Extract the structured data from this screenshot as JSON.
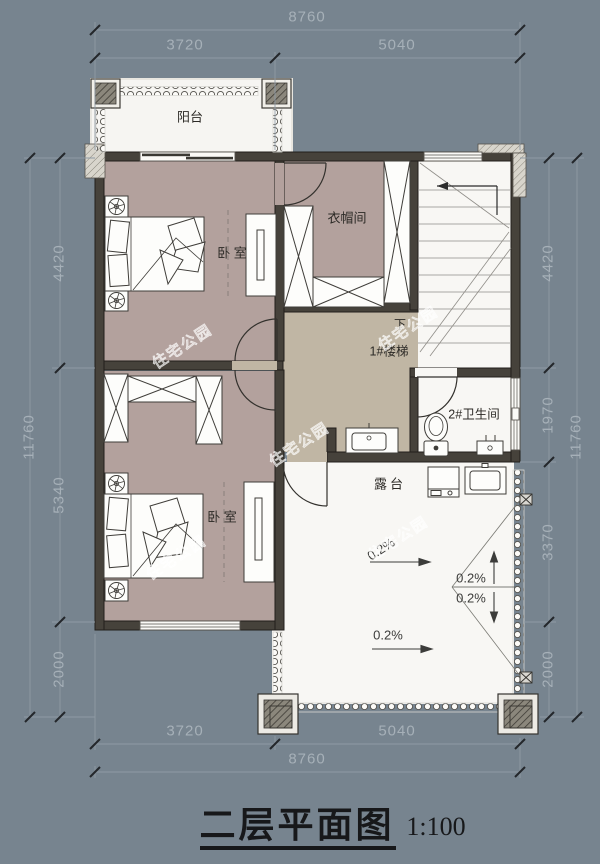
{
  "title": {
    "main": "二层平面图",
    "scale": "1:100"
  },
  "watermark": {
    "text": "住宅公园"
  },
  "rooms": {
    "balcony": "阳台",
    "bedroom_top": "卧 室",
    "cloakroom": "衣帽间",
    "stairs_direction": "下",
    "stairs_name": "1#楼梯",
    "bathroom": "2#卫生间",
    "bedroom_bottom": "卧 室",
    "terrace": "露台"
  },
  "dimensions": {
    "top": {
      "total": "8760",
      "segments": [
        "3720",
        "5040"
      ]
    },
    "bottom": {
      "total": "8760",
      "segments": [
        "3720",
        "5040"
      ]
    },
    "left": {
      "total": "11760",
      "segments": [
        "4420",
        "5340",
        "2000"
      ]
    },
    "right": {
      "total": "11760",
      "segments": [
        "4420",
        "1970",
        "3370",
        "2000"
      ]
    }
  },
  "slopes": {
    "labels": [
      "0.2%",
      "0.2%",
      "0.2%",
      "0.2%"
    ]
  },
  "colors": {
    "background": "#77848f",
    "bedroom_floor": "#b3a19d",
    "hall_floor": "#c0b6a4",
    "wall": "#46423b",
    "light_floor": "#f8f7f4",
    "dim_text": "#a6b0b8",
    "label_text": "#2c2a26"
  }
}
